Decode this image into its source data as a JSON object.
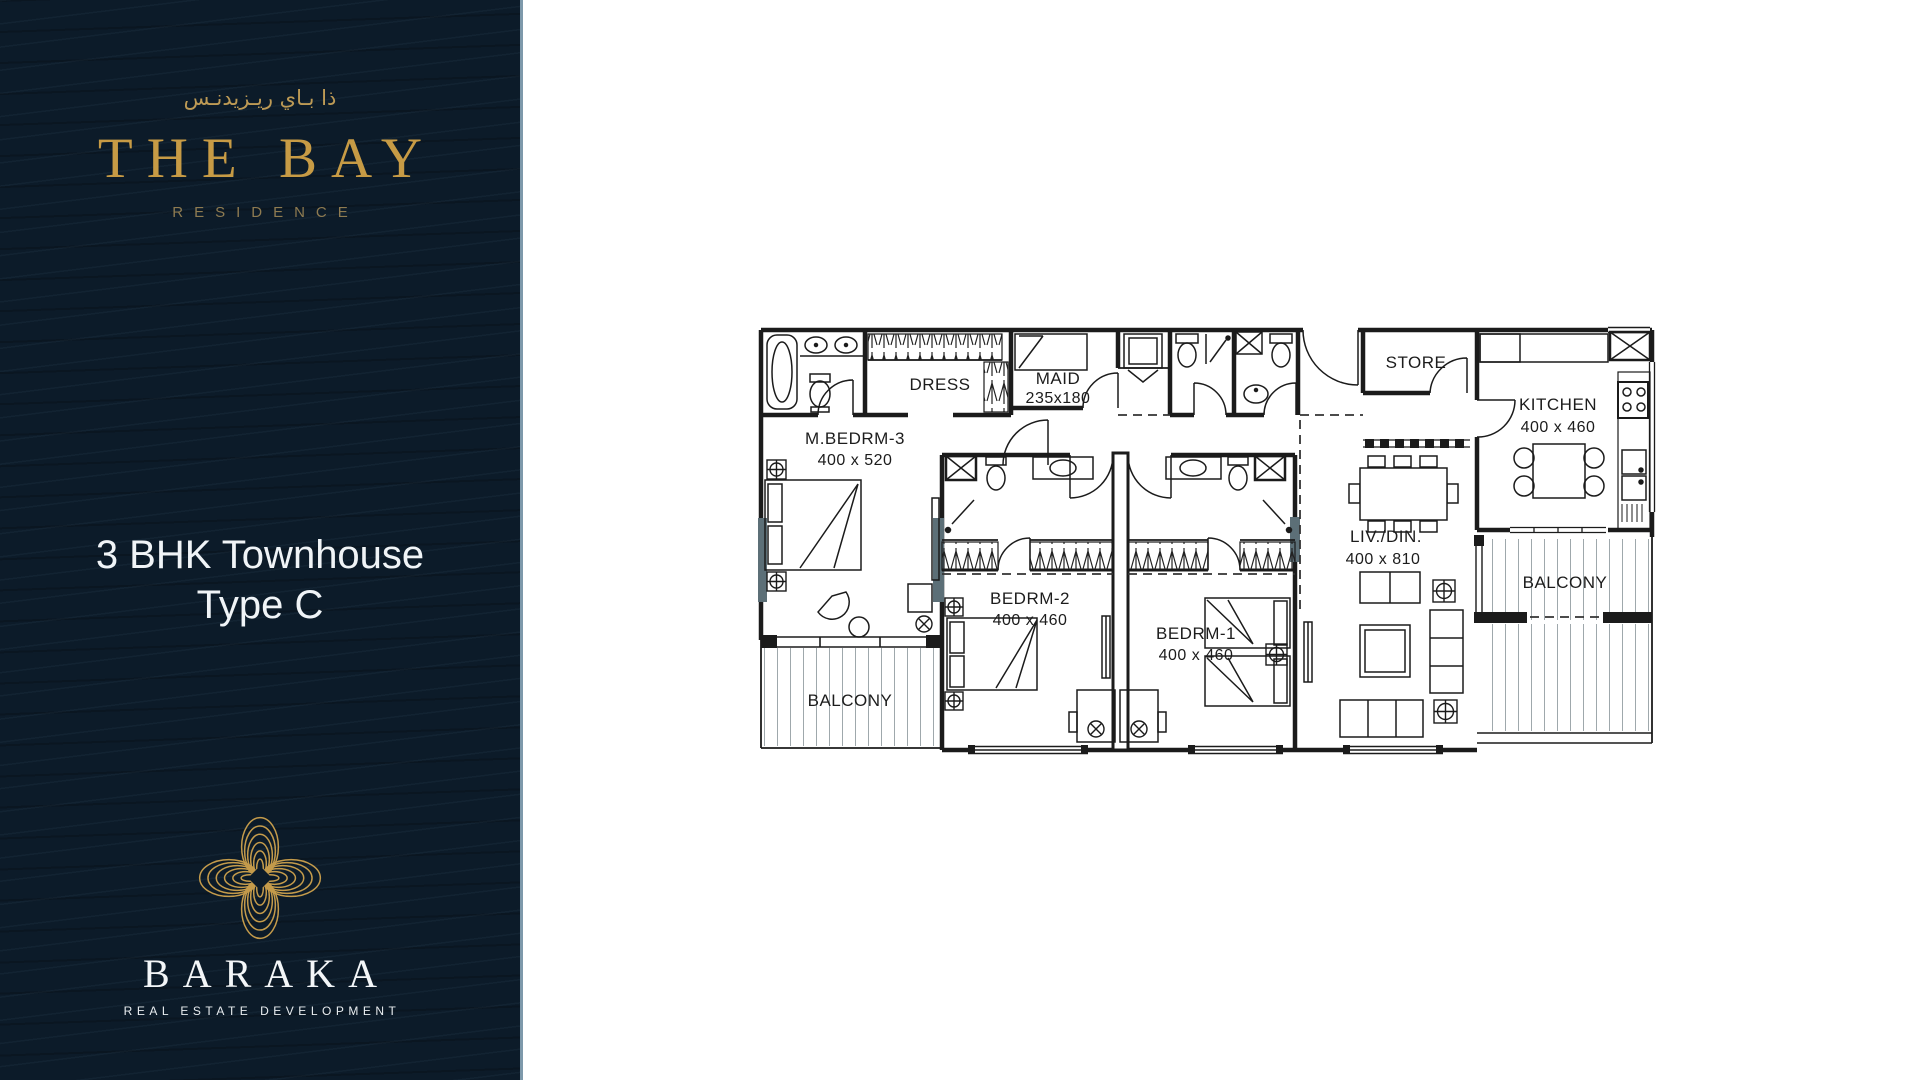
{
  "sidebar": {
    "brand_arabic": "ذا بـاي ريـزيدنـس",
    "brand_name": "THE BAY",
    "brand_sub": "RESIDENCE",
    "unit_title_line1": "3 BHK Townhouse",
    "unit_title_line2": "Type C",
    "developer_name": "BARAKA",
    "developer_sub": "REAL ESTATE DEVELOPMENT",
    "colors": {
      "background": "#0C1B29",
      "gold": "#C79B45",
      "gold_dim": "#8E7B51",
      "text_white": "#F0F4F7",
      "edge_line": "#7E99AB"
    }
  },
  "floorplan": {
    "labels": {
      "dress": {
        "name": "DRESS"
      },
      "maid": {
        "name": "MAID",
        "dims": "235x180"
      },
      "store": {
        "name": "STORE"
      },
      "kitchen": {
        "name": "KITCHEN",
        "dims": "400 x 460"
      },
      "mbedrm3": {
        "name": "M.BEDRM-3",
        "dims": "400 x 520"
      },
      "livdin": {
        "name": "LIV./DIN.",
        "dims": "400 x 810"
      },
      "bedrm2": {
        "name": "BEDRM-2",
        "dims": "400 x 460"
      },
      "bedrm1": {
        "name": "BEDRM-1",
        "dims": "400 x 460"
      },
      "balcony_left": {
        "name": "BALCONY"
      },
      "balcony_right": {
        "name": "BALCONY"
      }
    },
    "colors": {
      "wall_line": "#1b1b1b",
      "slate_column": "#5C6F77",
      "deck_line": "#9FA8AC",
      "paper": "#FFFFFF"
    }
  }
}
